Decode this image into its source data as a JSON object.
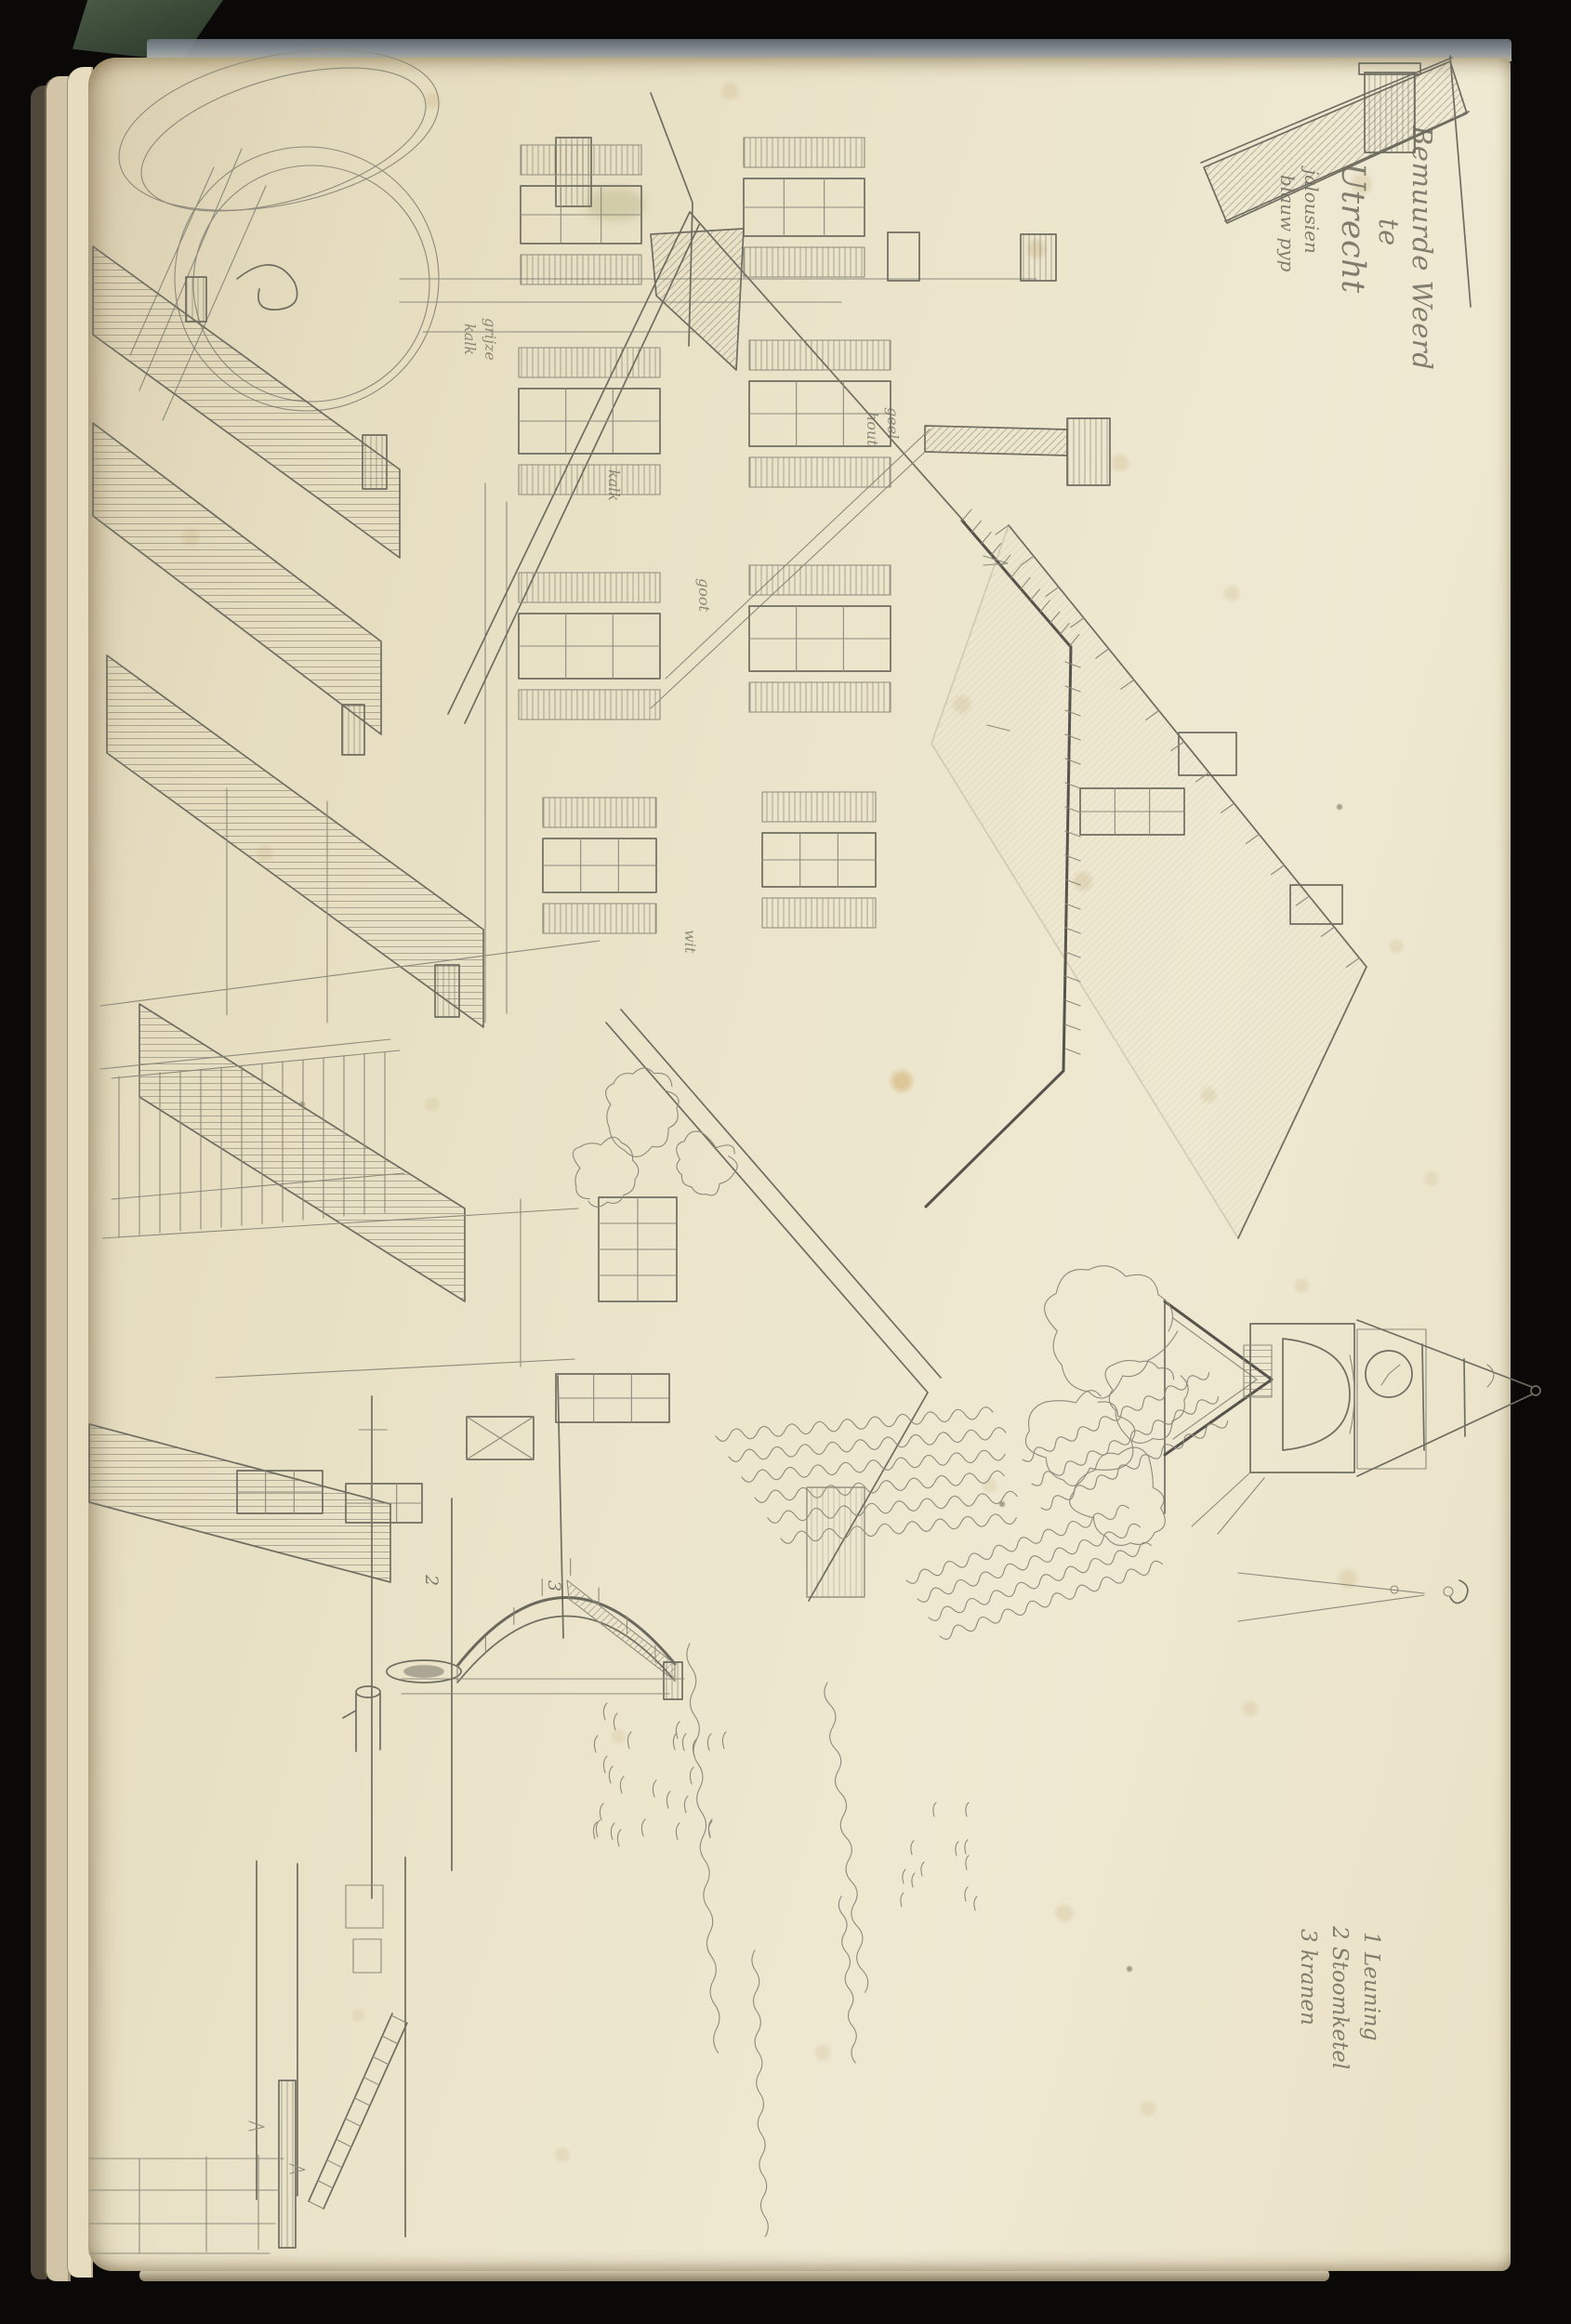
{
  "artifact": {
    "kind": "scanned sketchbook page, graphite pencil drawing of Dutch street with houses, bridge and clock tower, drawn rotated 90 degrees on the page"
  },
  "annotations": {
    "title": {
      "lines": [
        "Bemuurde Weerd",
        "te",
        "Utrecht"
      ]
    },
    "materials_note": {
      "lines": [
        "jalousien",
        "blauw pyp"
      ]
    },
    "legend": {
      "lines": [
        "1 Leuning",
        "2 Stoomketel",
        "3 kranen"
      ]
    },
    "sketch_notes": {
      "grijze": "grijze",
      "kalk": "kalk",
      "kalk2": "kalk",
      "geel": "geel",
      "hout": "hout",
      "goot": "goot",
      "wit": "wit",
      "num2": "2",
      "num3": "3"
    }
  },
  "colors": {
    "scan_background": "#0a0908",
    "paper": "#ebe4ca",
    "paper_edge_stack": "#e6dcbf",
    "page_top_edge": "#97a0a6",
    "facing_page": "#969b87",
    "ribbon_green": "#324030",
    "pencil": "#6f6d61",
    "foxing": "#ad8442"
  }
}
